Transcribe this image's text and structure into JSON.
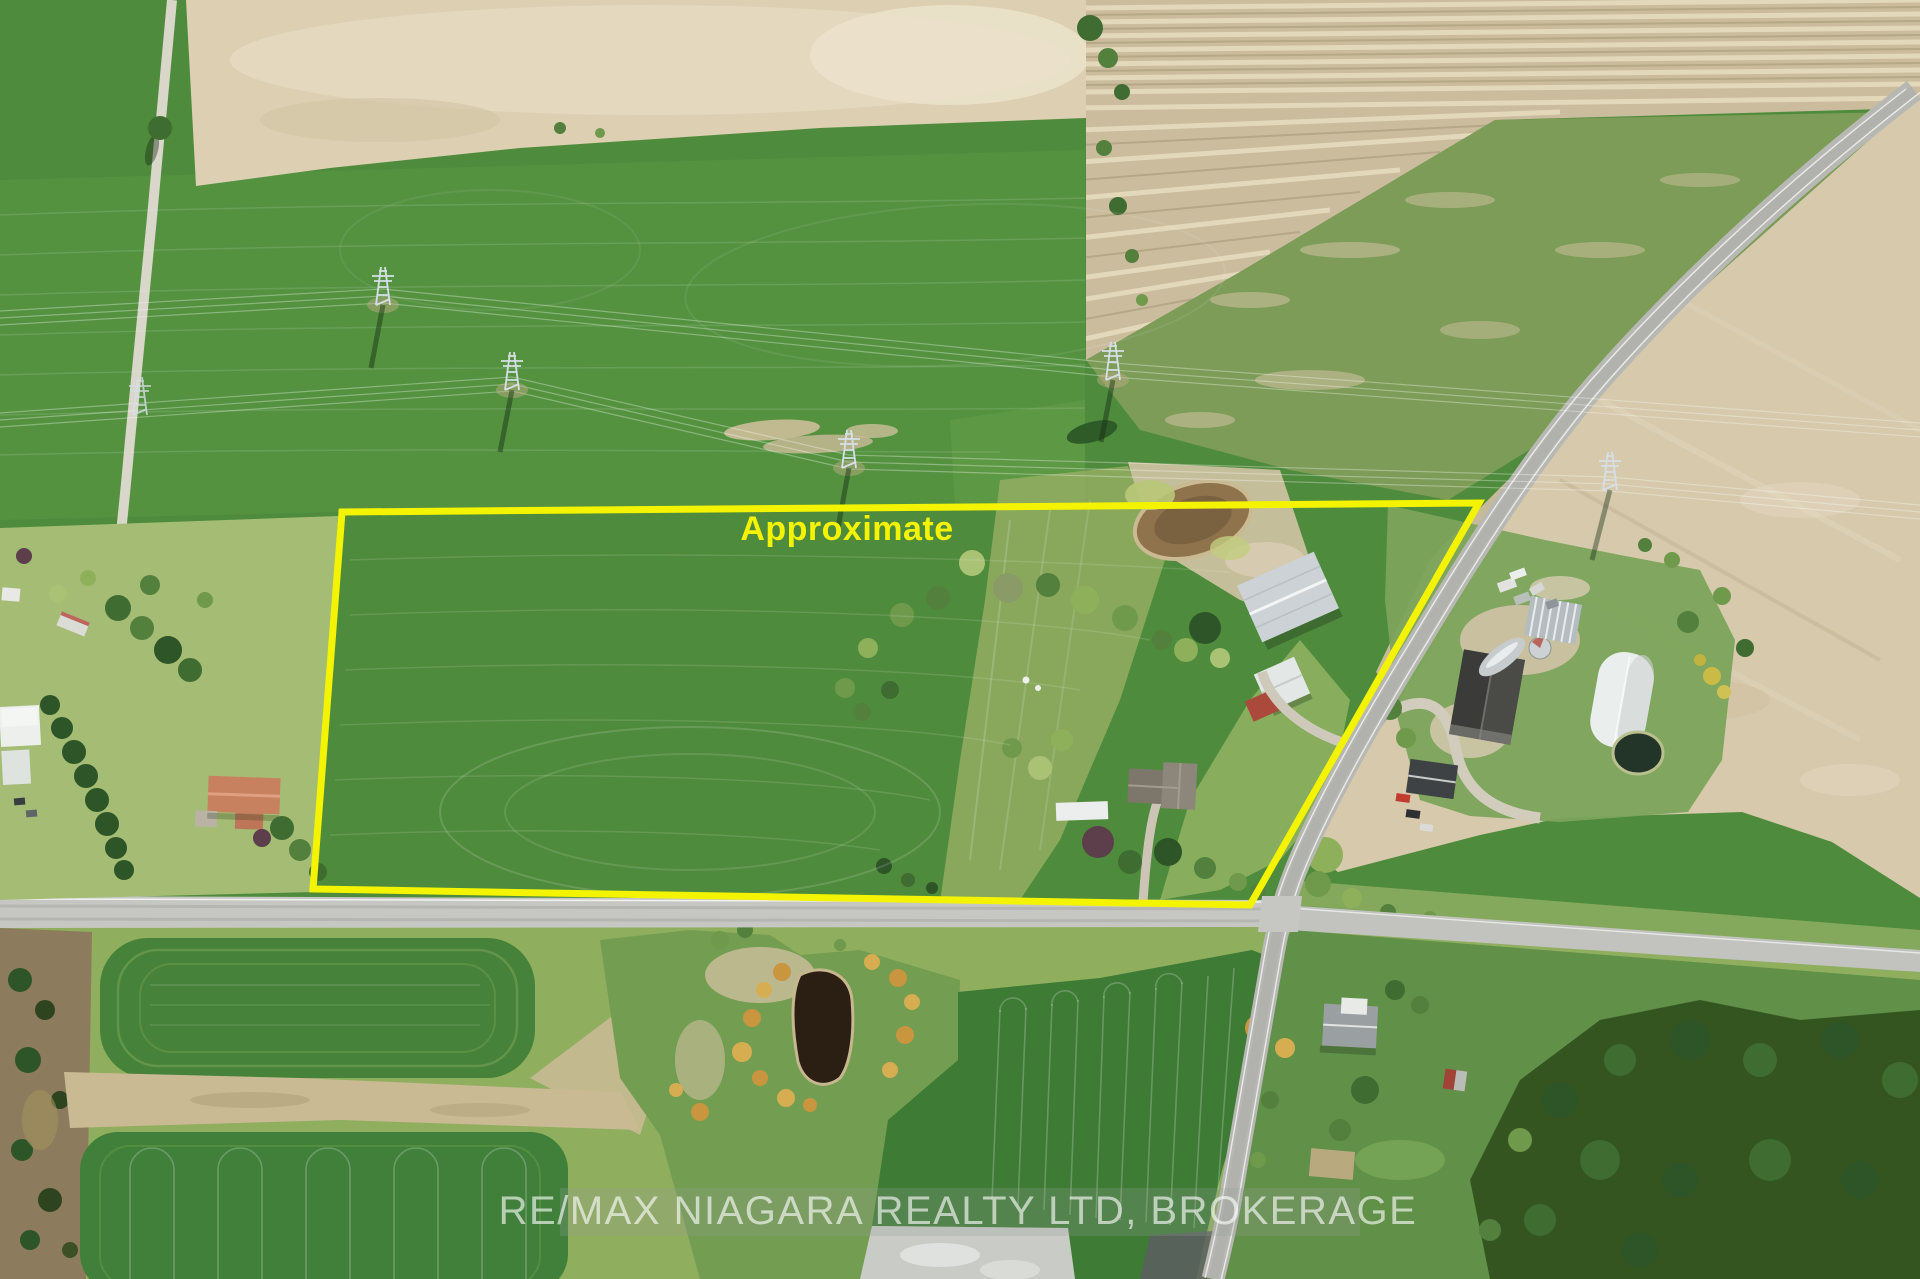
{
  "photo": {
    "type": "drone-aerial-photo",
    "scene": "Rural farmland with crop fields, country road intersection, farmsteads, ponds and hydro transmission towers"
  },
  "overlay": {
    "approximate_label": "Approximate",
    "boundary_color": "#f4f400",
    "watermark_text": "RE/MAX NIAGARA REALTY LTD, BROKERAGE"
  },
  "colors": {
    "crop_field_green": "#4f8b3c",
    "dark_field_green": "#3e7b35",
    "plowed_field_tan": "#dccfb2",
    "striped_field_tan": "#cabc9d",
    "road_gray": "#b7b8b3",
    "gravel_lane": "#d9d6ca",
    "farm_pond_brown": "#8f734c",
    "south_pond_dark": "#2b1e12"
  }
}
